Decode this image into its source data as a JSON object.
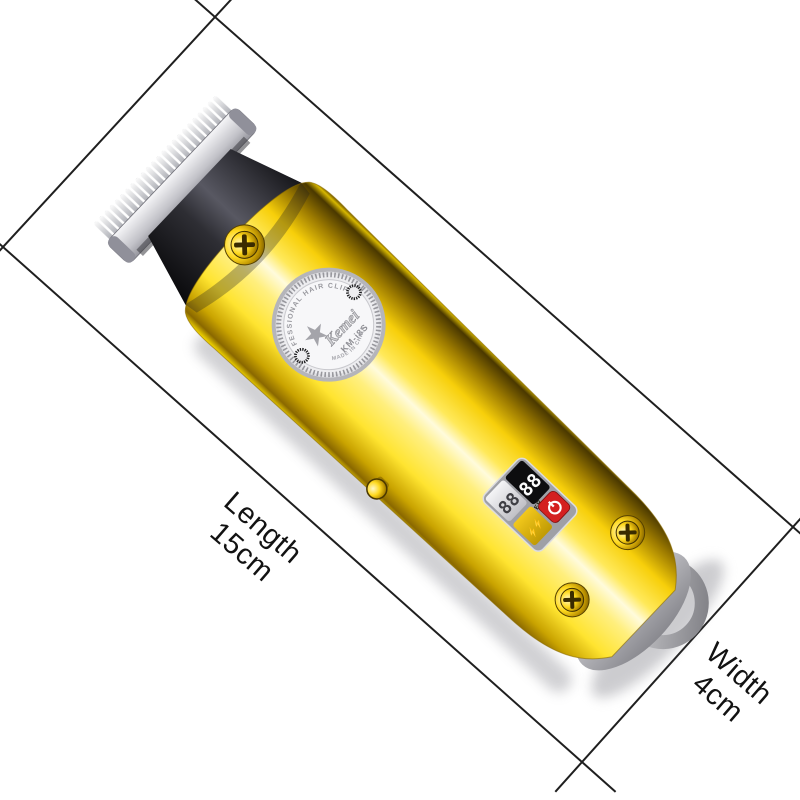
{
  "annotation": {
    "length_label": "Length",
    "length_value": "15cm",
    "width_label": "Width",
    "width_value": "4cm"
  },
  "product": {
    "badge": {
      "top_arc": "PROFESSIONAL HAIR CLIPPER",
      "star_icon": "★",
      "brand": "Kemei",
      "model": "KM-i8S",
      "bottom_arc": "MADE IN CHINA"
    },
    "display": {
      "left_digits": "88",
      "right_digits": "88",
      "power_label": "POWER",
      "charge_icons": "⚡⚡"
    }
  },
  "colors": {
    "dimension_line": "#1f1f1f",
    "label_text": "#121212",
    "body_gold_bright": "#ffe430",
    "body_gold_dark": "#8a6800",
    "head_dark": "#2e2e34",
    "blade_silver": "#d9d9de",
    "badge_face": "#f7f7f9",
    "lcd_black": "#0d0d0f",
    "button_red": "#d42020",
    "display_gold": "#e9bd10",
    "ring_grey": "#a9a9ad"
  }
}
